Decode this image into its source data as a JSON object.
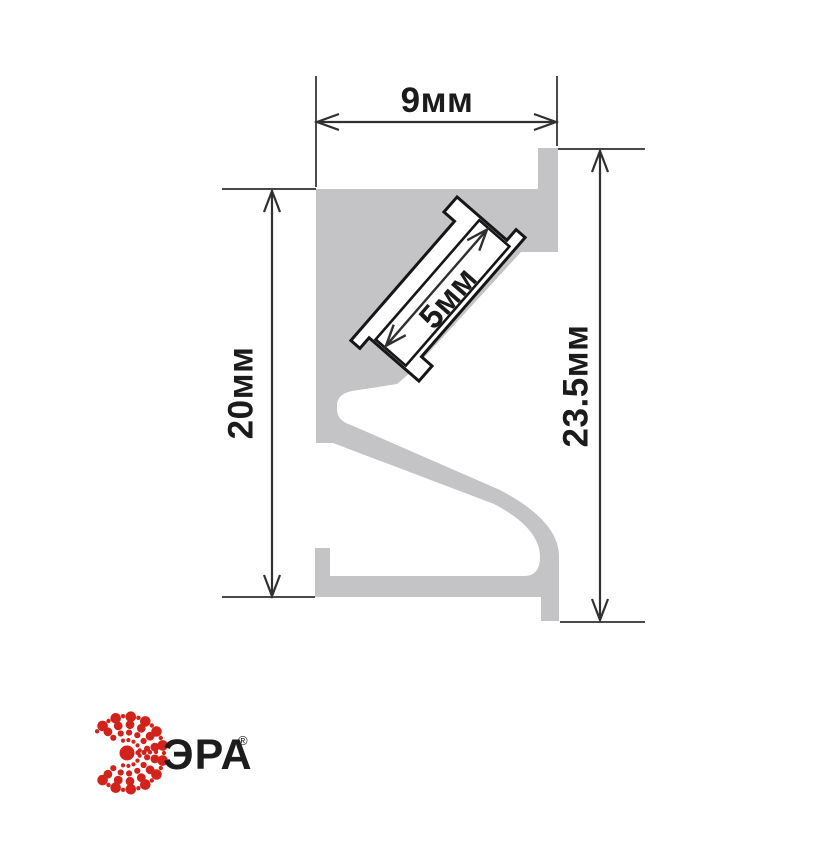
{
  "drawing": {
    "type": "led-profile-cross-section",
    "dimensions": {
      "top_width": {
        "label": "9мм"
      },
      "left_height": {
        "label": "20мм"
      },
      "right_height": {
        "label": "23.5мм"
      },
      "slot_width": {
        "label": "5мм"
      }
    },
    "colors": {
      "profile_fill": "#c4c3c5",
      "dimension_line": "#303030",
      "extension_line": "#4a4a4a",
      "channel_outline": "#161616",
      "label_text": "#1b1b1b",
      "background": "#ffffff"
    }
  },
  "brand": {
    "name": "ЭРА",
    "registered_mark": "®",
    "logo_color": "#d1221b",
    "text_color": "#1c1c1c"
  }
}
